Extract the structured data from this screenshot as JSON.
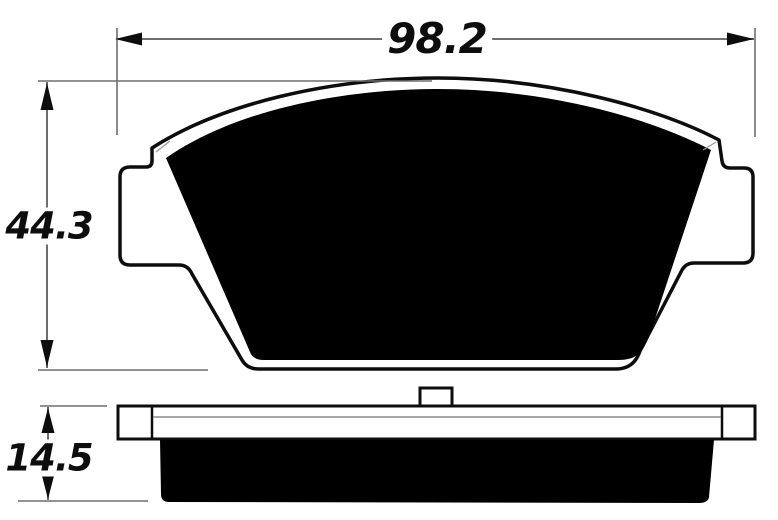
{
  "figure": {
    "colors": {
      "background": "#ffffff",
      "ink": "#0d0d0d",
      "friction_fill": "#000000",
      "dimension_line": "#6e6e6e",
      "thin_plate_line": "#8a8a8a"
    },
    "dimensions": {
      "width": {
        "label": "98.2"
      },
      "height": {
        "label": "44.3"
      },
      "thickness": {
        "label": "14.5"
      }
    }
  }
}
